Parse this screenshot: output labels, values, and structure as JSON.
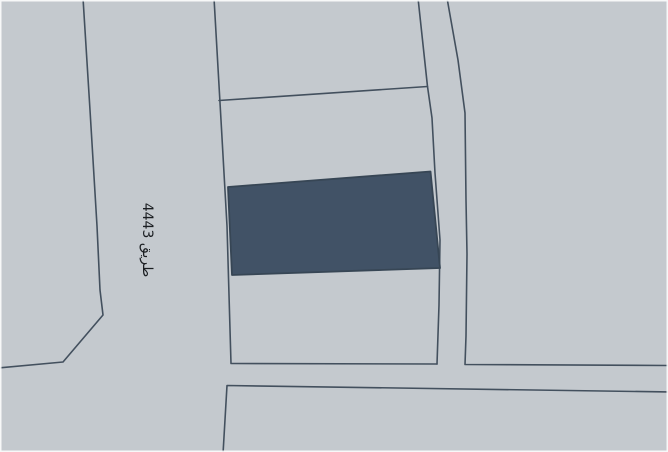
{
  "map": {
    "road_label": "طريق 4443",
    "colors": {
      "background": "#c4c9ce",
      "boundary_line": "#43505e",
      "highlighted_parcel_fill": "#415266",
      "highlighted_parcel_stroke": "#374655",
      "road_label_color": "#1b1e22",
      "frame_border": "#fdfdfd"
    }
  }
}
